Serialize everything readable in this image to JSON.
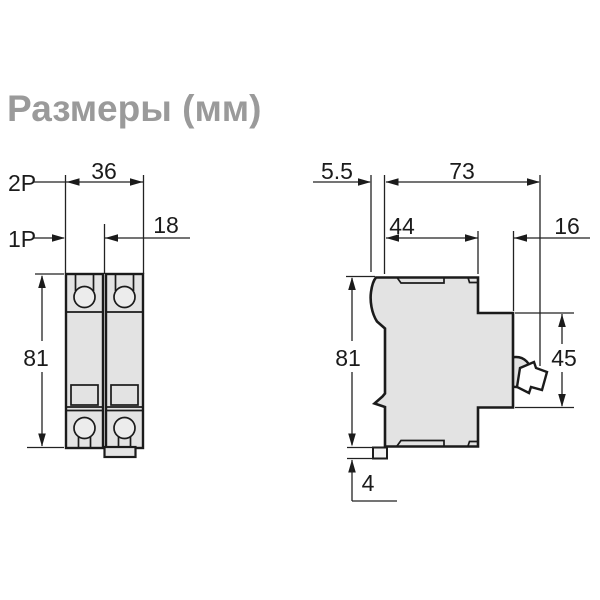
{
  "title": "Размеры (мм)",
  "front_view": {
    "pole_2_label": "2P",
    "pole_1_label": "1P",
    "width_2p_mm": "36",
    "width_1p_mm": "18",
    "height_mm": "81"
  },
  "side_view": {
    "rail_offset_mm": "5.5",
    "total_depth_mm": "73",
    "body_depth_mm": "44",
    "handle_depth_mm": "16",
    "height_mm": "81",
    "front_face_mm": "45",
    "foot_mm": "4"
  },
  "colors": {
    "line": "#1b1b1b",
    "fill": "#e3e3e3",
    "title_gray": "#9a9a9a",
    "background": "#ffffff"
  }
}
